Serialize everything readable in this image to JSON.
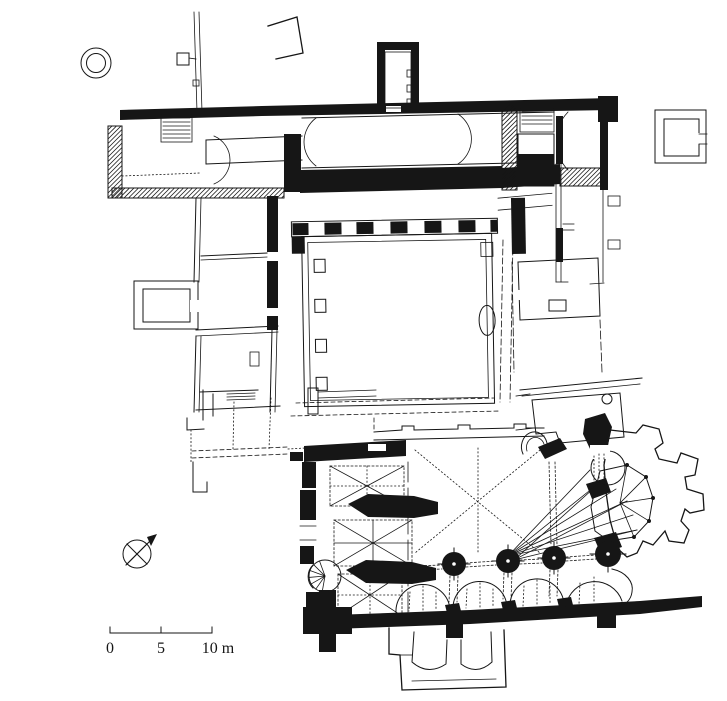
{
  "canvas": {
    "width": 727,
    "height": 701,
    "paper_color": "#ffffff",
    "ink_color": "#161616"
  },
  "scale_bar": {
    "labels": [
      "0",
      "5",
      "10 m"
    ],
    "unit": "m"
  },
  "symbols": [
    {
      "name": "north-arrow-icon",
      "shape": "circle with thin X cross and thick needle pointing north-east with barb"
    },
    {
      "name": "well-icon",
      "shape": "double concentric circle"
    }
  ],
  "plan_elements": [
    "precinct-wall-fragment",
    "outbuilding-outline",
    "north-range-hall",
    "north-latrine-tower",
    "east-wing",
    "detached-square-building",
    "cloister-garth",
    "cloister-walks",
    "west-range",
    "west-annex",
    "southwest-ruins",
    "east-range",
    "sacristy-ruins",
    "church-west-tower",
    "spiral-stair",
    "nave-arcade-piers",
    "south-aisle-chapels",
    "crossing-and-choir",
    "apse-with-radiating-chapels",
    "north-transept-chapels",
    "south-porch",
    "south-wall-buttresses"
  ]
}
